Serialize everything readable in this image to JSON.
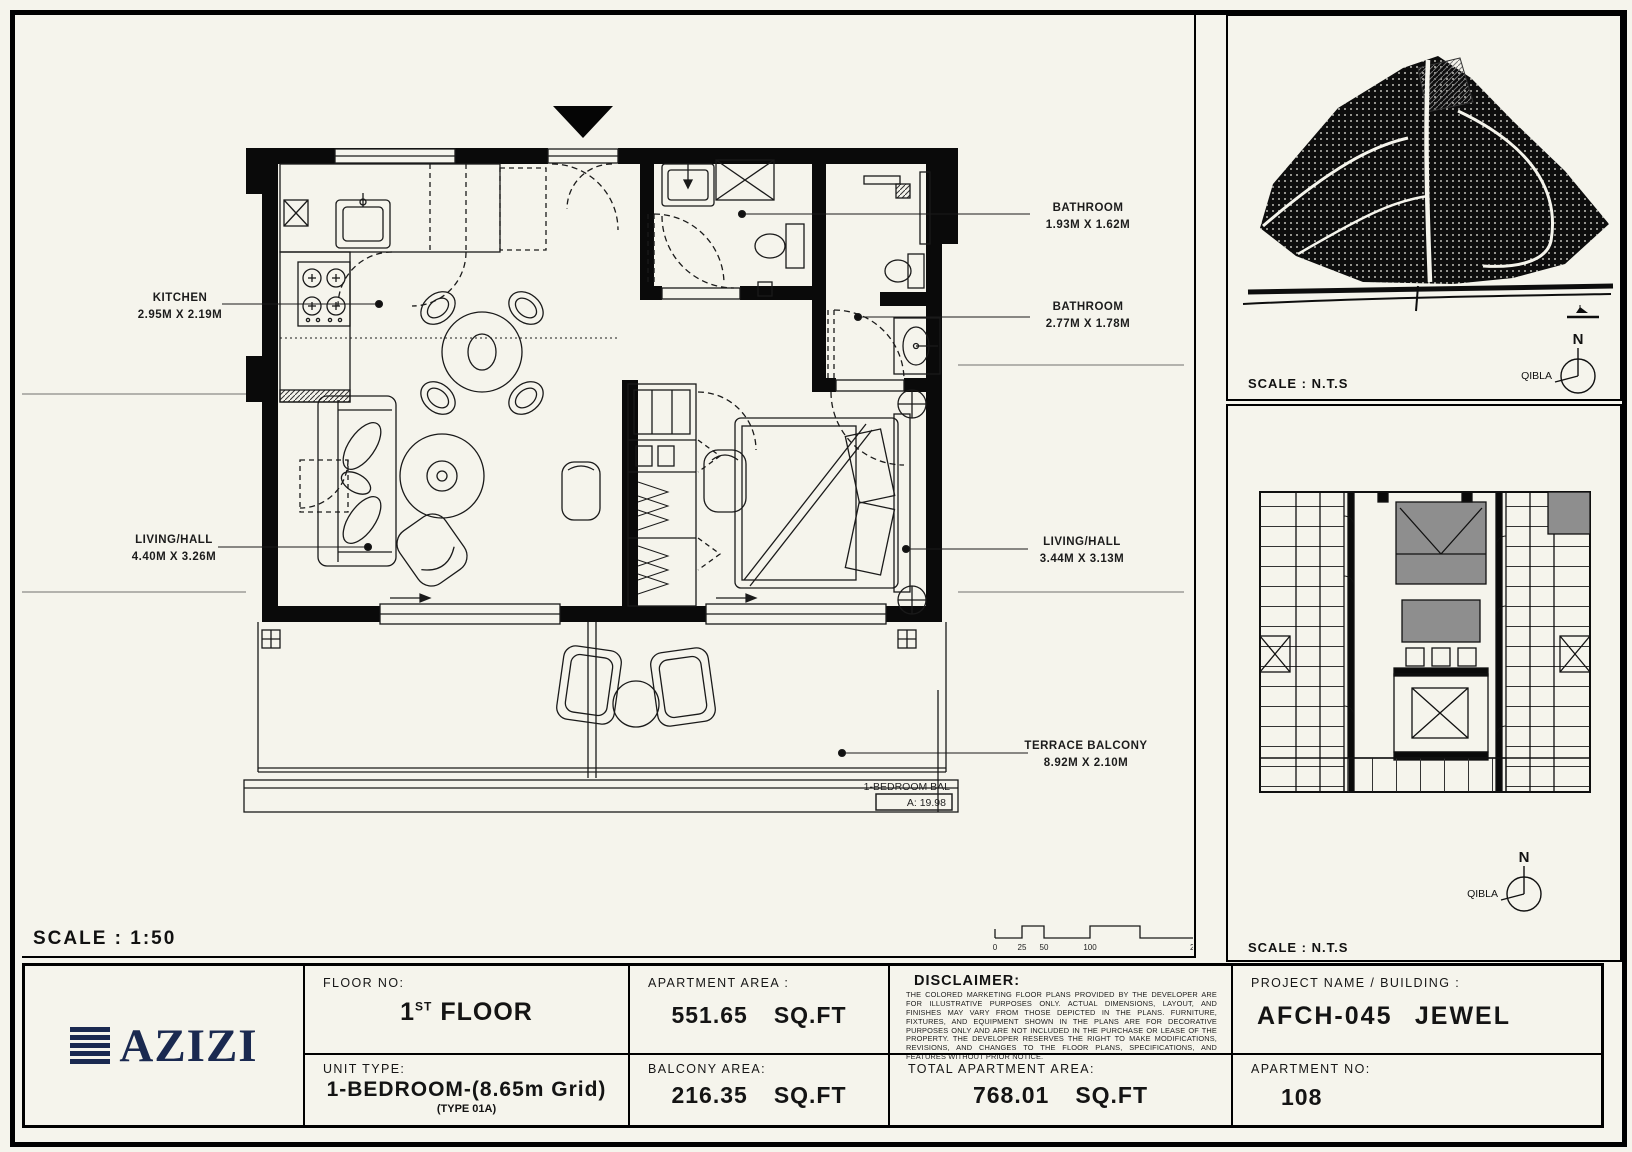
{
  "colors": {
    "paper": "#f5f4ec",
    "ink": "#111111",
    "accent_navy": "#1a2950",
    "gray_block": "#8e8e8e"
  },
  "plan": {
    "scale_label": "SCALE : 1:50",
    "rooms": [
      {
        "name": "KITCHEN",
        "dims": "2.95M X 2.19M"
      },
      {
        "name": "LIVING/HALL",
        "dims": "4.40M X 3.26M"
      },
      {
        "name": "BATHROOM",
        "dims": "1.93M X 1.62M"
      },
      {
        "name": "BATHROOM",
        "dims": "2.77M X 1.78M"
      },
      {
        "name": "LIVING/HALL",
        "dims": "3.44M X 3.13M"
      },
      {
        "name": "TERRACE BALCONY",
        "dims": "8.92M X 2.10M"
      }
    ],
    "balcony_tag": {
      "line1": "1-BEDROOM BAL",
      "line2": "A: 19.98"
    },
    "scalebar": {
      "ticks": [
        "0",
        "25",
        "50",
        "100",
        "250m"
      ]
    }
  },
  "site_panel": {
    "scale_text": "SCALE : N.T.S",
    "north": "N",
    "qibla": "QIBLA"
  },
  "key_panel": {
    "scale_text": "SCALE : N.T.S",
    "north": "N",
    "qibla": "QIBLA"
  },
  "titleblock": {
    "logo_text": "AZIZI",
    "floor": {
      "label": "FLOOR NO:",
      "num": "1",
      "sup": "ST",
      "rest": "FLOOR"
    },
    "unit": {
      "label": "UNIT TYPE:",
      "value": "1-BEDROOM-(8.65m Grid)",
      "subvalue": "(TYPE 01A)"
    },
    "apartment_area": {
      "label": "APARTMENT AREA :",
      "value": "551.65",
      "unit": "SQ.FT"
    },
    "balcony_area": {
      "label": "BALCONY AREA:",
      "value": "216.35",
      "unit": "SQ.FT"
    },
    "disclaimer": {
      "label": "DISCLAIMER:",
      "text": "THE COLORED MARKETING FLOOR PLANS PROVIDED BY THE DEVELOPER ARE FOR ILLUSTRATIVE PURPOSES ONLY. ACTUAL DIMENSIONS, LAYOUT, AND FINISHES MAY VARY FROM THOSE DEPICTED IN THE PLANS. FURNITURE, FIXTURES, AND EQUIPMENT SHOWN IN THE PLANS ARE FOR DECORATIVE PURPOSES ONLY AND ARE NOT INCLUDED IN THE PURCHASE OR LEASE OF THE PROPERTY. THE DEVELOPER RESERVES THE RIGHT TO MAKE MODIFICATIONS, REVISIONS, AND CHANGES TO THE FLOOR PLANS, SPECIFICATIONS, AND FEATURES WITHOUT PRIOR NOTICE."
    },
    "total_area": {
      "label": "TOTAL APARTMENT AREA:",
      "value": "768.01",
      "unit": "SQ.FT"
    },
    "project": {
      "label": "PROJECT NAME / BUILDING :",
      "code": "AFCH-045",
      "name": "JEWEL"
    },
    "apartment_no": {
      "label": "APARTMENT NO:",
      "value": "108"
    }
  }
}
